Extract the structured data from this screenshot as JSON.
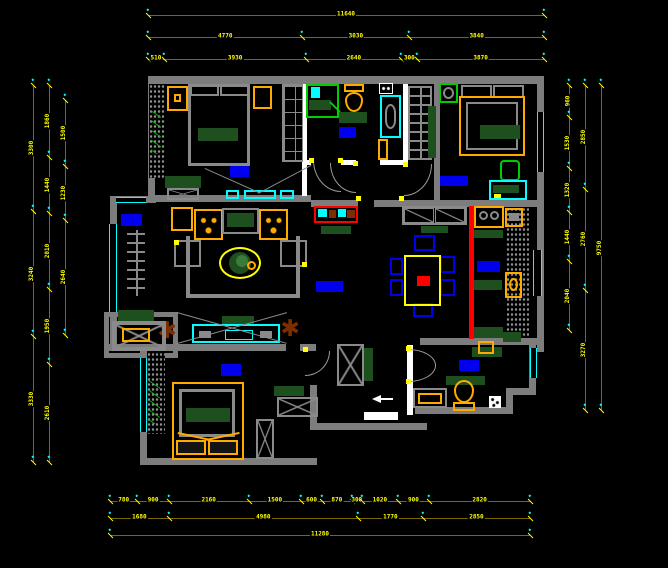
{
  "drawing": {
    "kind": "apartment-floor-plan",
    "style": "CAD blueprint, black background",
    "rooms": [
      "balcony",
      "bedroom-1",
      "bathroom-1",
      "bedroom-2",
      "living-room",
      "hallway",
      "kitchen-dining",
      "bedroom-3",
      "bathroom-2"
    ]
  },
  "palette": {
    "background": "#000000",
    "wall_gray": "#7d7d7d",
    "partition_white": "#ffffff",
    "window_cyan": "#00ffff",
    "furniture_orange": "#ffaa00",
    "dimension_text_yellow": "#ffff00",
    "dimension_line_olive": "#7a6a00",
    "room_label_blue": "#0000ee",
    "counter_green": "#1e4f1e",
    "fixture_green": "#00cc00",
    "divider_red": "#ff0000",
    "plant_brown": "#7b2f00",
    "chair_blue": "#0000ee"
  },
  "dimensions": {
    "chains": [
      {
        "dir": "h",
        "x": 148,
        "y": 10,
        "len": 396,
        "segs": [
          {
            "v": "11640",
            "f": 1
          }
        ]
      },
      {
        "dir": "h",
        "x": 148,
        "y": 32,
        "len": 396,
        "segs": [
          {
            "v": "4770",
            "f": 0.39
          },
          {
            "v": "3030",
            "f": 0.27
          },
          {
            "v": "3840",
            "f": 0.34
          }
        ]
      },
      {
        "dir": "h",
        "x": 148,
        "y": 54,
        "len": 396,
        "segs": [
          {
            "v": "510",
            "f": 0.04
          },
          {
            "v": "3930",
            "f": 0.36
          },
          {
            "v": "2640",
            "f": 0.24
          },
          {
            "v": "300",
            "f": 0.04
          },
          {
            "v": "3870",
            "f": 0.32
          }
        ]
      },
      {
        "dir": "h",
        "x": 110,
        "y": 496,
        "len": 420,
        "segs": [
          {
            "v": "780",
            "f": 0.065
          },
          {
            "v": "900",
            "f": 0.075
          },
          {
            "v": "2160",
            "f": 0.19
          },
          {
            "v": "1500",
            "f": 0.125
          },
          {
            "v": "600",
            "f": 0.05
          },
          {
            "v": "870",
            "f": 0.07
          },
          {
            "v": "300",
            "f": 0.025
          },
          {
            "v": "1020",
            "f": 0.085
          },
          {
            "v": "900",
            "f": 0.075
          },
          {
            "v": "2820",
            "f": 0.24
          }
        ]
      },
      {
        "dir": "h",
        "x": 110,
        "y": 513,
        "len": 420,
        "segs": [
          {
            "v": "1680",
            "f": 0.14
          },
          {
            "v": "4980",
            "f": 0.45
          },
          {
            "v": "1770",
            "f": 0.155
          },
          {
            "v": "2850",
            "f": 0.255
          }
        ]
      },
      {
        "dir": "h",
        "x": 110,
        "y": 530,
        "len": 420,
        "segs": [
          {
            "v": "11280",
            "f": 1
          }
        ]
      },
      {
        "dir": "v",
        "x": 28,
        "y": 85,
        "len": 377,
        "segs": [
          {
            "v": "3300",
            "f": 0.335
          },
          {
            "v": "3240",
            "f": 0.33
          },
          {
            "v": "3330",
            "f": 0.335
          }
        ]
      },
      {
        "dir": "v",
        "x": 44,
        "y": 85,
        "len": 377,
        "segs": [
          {
            "v": "1860",
            "f": 0.19
          },
          {
            "v": "1440",
            "f": 0.15
          },
          {
            "v": "2010",
            "f": 0.2
          },
          {
            "v": "1950",
            "f": 0.2
          },
          {
            "v": "2610",
            "f": 0.26
          }
        ]
      },
      {
        "dir": "v",
        "x": 60,
        "y": 100,
        "len": 235,
        "segs": [
          {
            "v": "1500",
            "f": 0.28
          },
          {
            "v": "1230",
            "f": 0.23
          },
          {
            "v": "2640",
            "f": 0.49
          }
        ]
      },
      {
        "dir": "v",
        "x": 564,
        "y": 85,
        "len": 245,
        "segs": [
          {
            "v": "960",
            "f": 0.13
          },
          {
            "v": "1530",
            "f": 0.21
          },
          {
            "v": "1320",
            "f": 0.18
          },
          {
            "v": "1440",
            "f": 0.2
          },
          {
            "v": "2040",
            "f": 0.28
          }
        ]
      },
      {
        "dir": "v",
        "x": 580,
        "y": 85,
        "len": 325,
        "segs": [
          {
            "v": "2850",
            "f": 0.32
          },
          {
            "v": "2760",
            "f": 0.31
          },
          {
            "v": "3270",
            "f": 0.37
          }
        ]
      },
      {
        "dir": "v",
        "x": 596,
        "y": 85,
        "len": 325,
        "segs": [
          {
            "v": "9750",
            "f": 1
          }
        ]
      }
    ]
  },
  "icons": {
    "plants": "starburst-plant-icon",
    "entry_arrow": "entry-direction-arrow",
    "room_labels": "solid blue highlighted text blocks (text not legible)"
  },
  "glyphs": {
    "starburst": "✱"
  }
}
